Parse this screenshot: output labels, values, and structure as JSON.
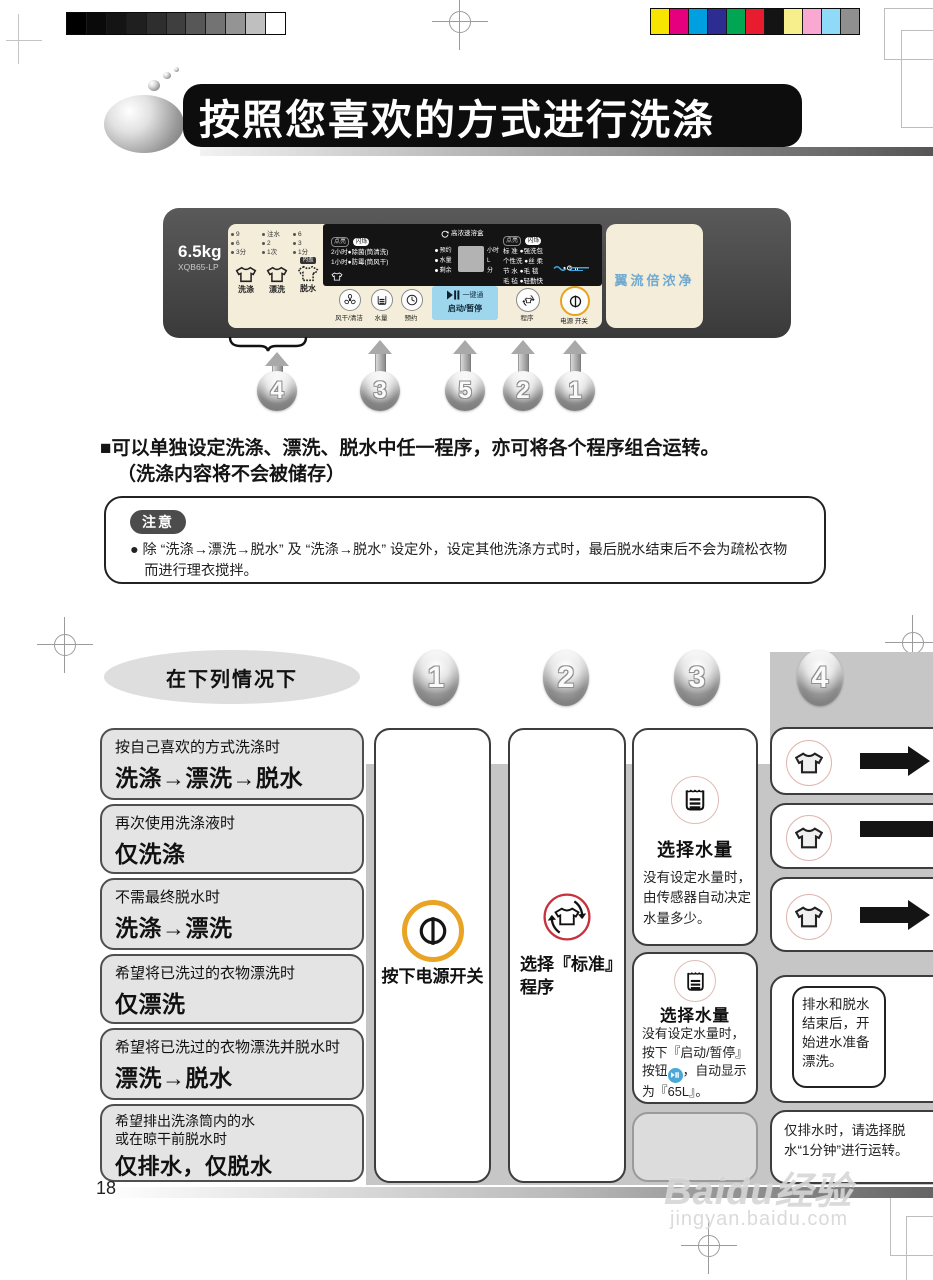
{
  "page": {
    "number": "18"
  },
  "header": {
    "title": "按照您喜欢的方式进行洗涤"
  },
  "panel": {
    "capacity": "6.5kg",
    "model": "XQB65-LP",
    "wash": {
      "label": "洗涤",
      "opts": [
        "9",
        "6",
        "3分"
      ]
    },
    "rinse": {
      "label": "漂洗",
      "opts": [
        "注水",
        "2",
        "1次"
      ]
    },
    "spin": {
      "label": "脱水",
      "opts": [
        "6",
        "3",
        "1分"
      ],
      "badge": "内盖"
    },
    "timer": {
      "badge_on": "点亮",
      "badge_blink": "闪烁",
      "line1": "2小时●除菌(筒清洗)",
      "line2": "1小时●防霉(筒风干)"
    },
    "dispenser": "高浓速溶盒",
    "display": {
      "rows": [
        {
          "l": "预约",
          "r": "小时"
        },
        {
          "l": "水量",
          "r": "L"
        },
        {
          "l": "剩余",
          "r": "分"
        }
      ]
    },
    "programs": {
      "badge_on": "点亮",
      "badge_blink": "闪烁",
      "rows": [
        {
          "l": "标 准",
          "r": "强洗包"
        },
        {
          "l": "个性洗",
          "r": "丝 柔"
        },
        {
          "l": "节 水",
          "r": "毛 毯"
        },
        {
          "l": "毛 毡",
          "r": "轻勤快"
        }
      ]
    },
    "buttons": {
      "dry": "风干/清洁",
      "water": "水量",
      "reserve": "预约",
      "start": "启动/暂停",
      "onetouch": "一键通",
      "program": "程序",
      "power": "电源 开关"
    },
    "brand_text": "翼流倍浓净"
  },
  "callouts": {
    "panel": [
      "4",
      "3",
      "5",
      "2",
      "1"
    ]
  },
  "intro": {
    "line1": "■可以单独设定洗涤、漂洗、脱水中任一程序，亦可将各个程序组合运转。",
    "line2": "（洗涤内容将不会被储存）"
  },
  "notice": {
    "badge": "注意",
    "text": "● 除 “洗涤→漂洗→脱水” 及 “洗涤→脱水” 设定外，设定其他洗涤方式时，最后脱水结束后不会为疏松衣物\n　而进行理衣搅拌。"
  },
  "table": {
    "situation_header": "在下列情况下",
    "steps": [
      "1",
      "2",
      "3",
      "4"
    ],
    "conditions": [
      {
        "desc": "按自己喜欢的方式洗涤时",
        "mode": "洗涤→漂洗→脱水"
      },
      {
        "desc": "再次使用洗涤液时",
        "mode": "仅洗涤"
      },
      {
        "desc": "不需最终脱水时",
        "mode": "洗涤→漂洗"
      },
      {
        "desc": "希望将已洗过的衣物漂洗时",
        "mode": "仅漂洗"
      },
      {
        "desc": "希望将已洗过的衣物漂洗并脱水时",
        "mode": "漂洗→脱水"
      },
      {
        "desc": "希望排出洗涤筒内的水\n或在晾干前脱水时",
        "mode": "仅排水，仅脱水"
      }
    ],
    "step1_label": "按下电源开关",
    "step2_label": "选择『标准』\n程序",
    "step3a": {
      "title": "选择水量",
      "text": "没有设定水量时，由传感器自动决定水量多少。"
    },
    "step3b": {
      "title": "选择水量",
      "text_before": "没有设定水量时，按下『启动/暂停』按钮",
      "text_after": "，自动显示为『65L』。"
    },
    "step4_note1": "排水和脱水结束后，开始进水准备漂洗。",
    "step4_note2": "仅排水时，请选择脱水“1分钟”进行运转。"
  },
  "watermark": {
    "brand": "Baidu经验",
    "url": "jingyan.baidu.com"
  },
  "print": {
    "grayscale": [
      "#000000",
      "#0a0a0a",
      "#141414",
      "#1f1f1f",
      "#2e2e2e",
      "#3f3f3f",
      "#575757",
      "#737373",
      "#949494",
      "#bfbfbf",
      "#ffffff"
    ],
    "colors": [
      "#f7e400",
      "#e6007e",
      "#00a0e0",
      "#2d2d91",
      "#00a651",
      "#e81c2e",
      "#141414",
      "#f6ef8b",
      "#f9a8d2",
      "#8fd9f9",
      "#8f8f8f"
    ]
  }
}
